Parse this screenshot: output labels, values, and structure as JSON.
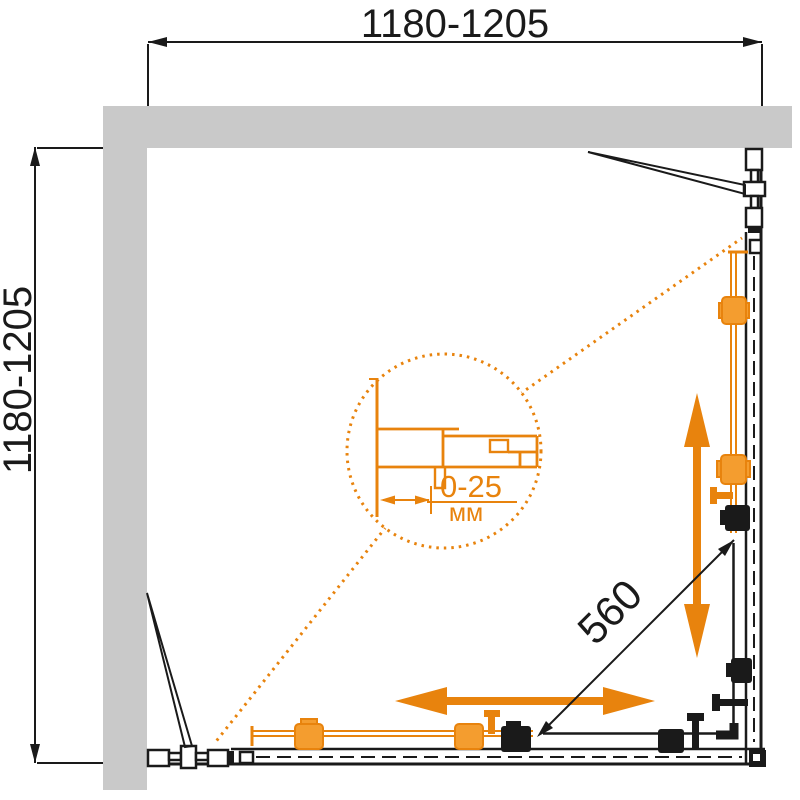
{
  "dimensions": {
    "width_label": "1180-1205",
    "depth_label": "1180-1205",
    "entry_label": "560"
  },
  "detail_callout": {
    "adjustment_label": "0-25",
    "unit_label": "мм"
  },
  "colors": {
    "accent": "#E8830D",
    "accent_fill": "#F49D2F",
    "wall_gray": "#C9C9C9",
    "line_black": "#1A1A1A",
    "background": "#FFFFFF"
  }
}
